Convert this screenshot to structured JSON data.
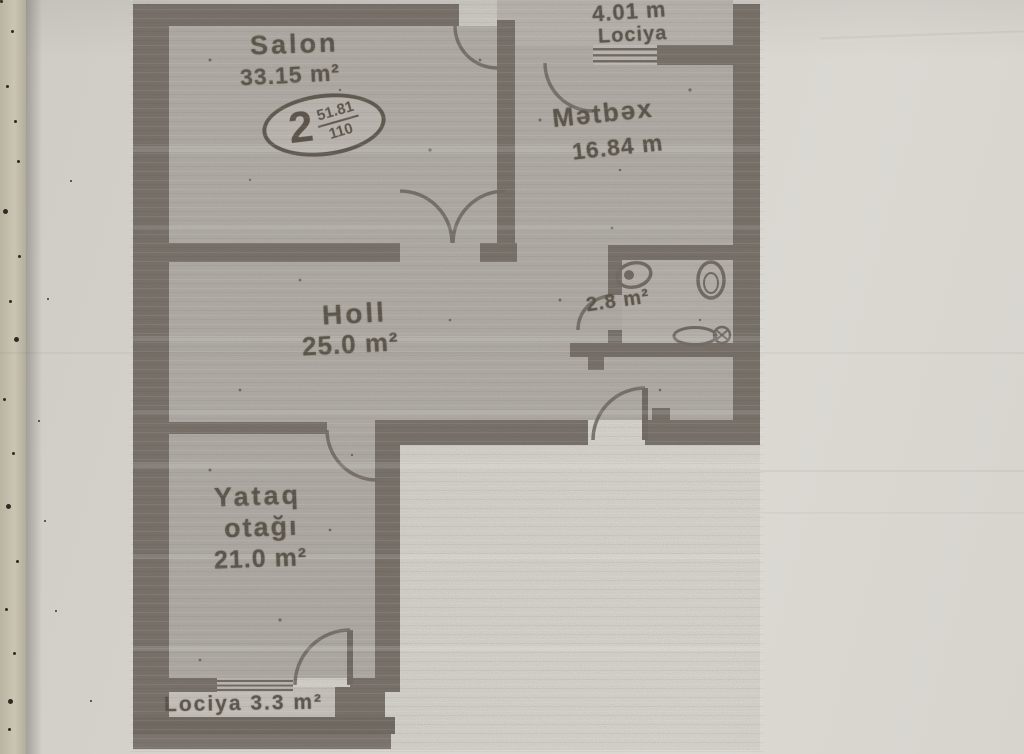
{
  "badge": {
    "number": "2",
    "numerator": "51.81",
    "denominator": "110"
  },
  "rooms": {
    "salon": {
      "name": "Salon",
      "area": "33.15 m²"
    },
    "kitchen": {
      "name": "Mətbəx",
      "area": "16.84 m"
    },
    "hall": {
      "name": "Holl",
      "area": "25.0 m²"
    },
    "bedroom": {
      "name_line1": "Yataq",
      "name_line2": "otağı",
      "area": "21.0 m²"
    },
    "bathroom": {
      "area": "2.8 m²"
    },
    "loggia_top": {
      "length": "4.01 m",
      "name": "Lociya"
    },
    "loggia_bottom": {
      "label": "Lociya 3.3 m²"
    }
  },
  "colors": {
    "wall": "#756e67",
    "room_fill": "#b1ada6",
    "loggia_fill": "#b9b5ae",
    "paper": "#d6d3cd",
    "ink": "#5a5248"
  }
}
